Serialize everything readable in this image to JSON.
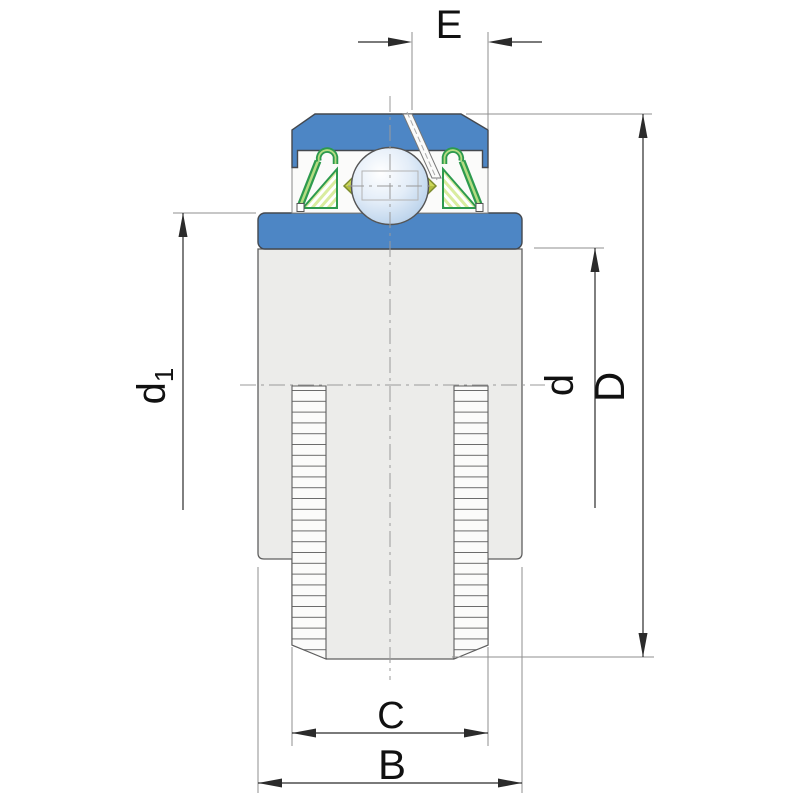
{
  "drawing": {
    "dimension_labels": {
      "top_width": "E",
      "left_diameter_main": "d",
      "left_diameter_subscript": "1",
      "right_inner_diameter": "d",
      "right_outer_diameter": "D",
      "bottom_inner_width": "C",
      "bottom_outer_width": "B"
    }
  },
  "colors": {
    "blue": "#4d86c5",
    "body": "#ececea",
    "body-line": "#5f5f5f",
    "white": "#fbfbfa",
    "green-dark": "#2d9a4e",
    "green-light": "#b4dc82",
    "green-pale": "#d9ec9f",
    "olive": "#cbd757",
    "olive-dark": "#b2bd3f",
    "olive-line": "#7d8c2e",
    "ball-edge": "#555555",
    "hidden-line": "#b3b3b3",
    "dim": "#2b2b2b",
    "ext": "#8f8f8f",
    "center": "#9a9a9a",
    "label": "#111111"
  }
}
